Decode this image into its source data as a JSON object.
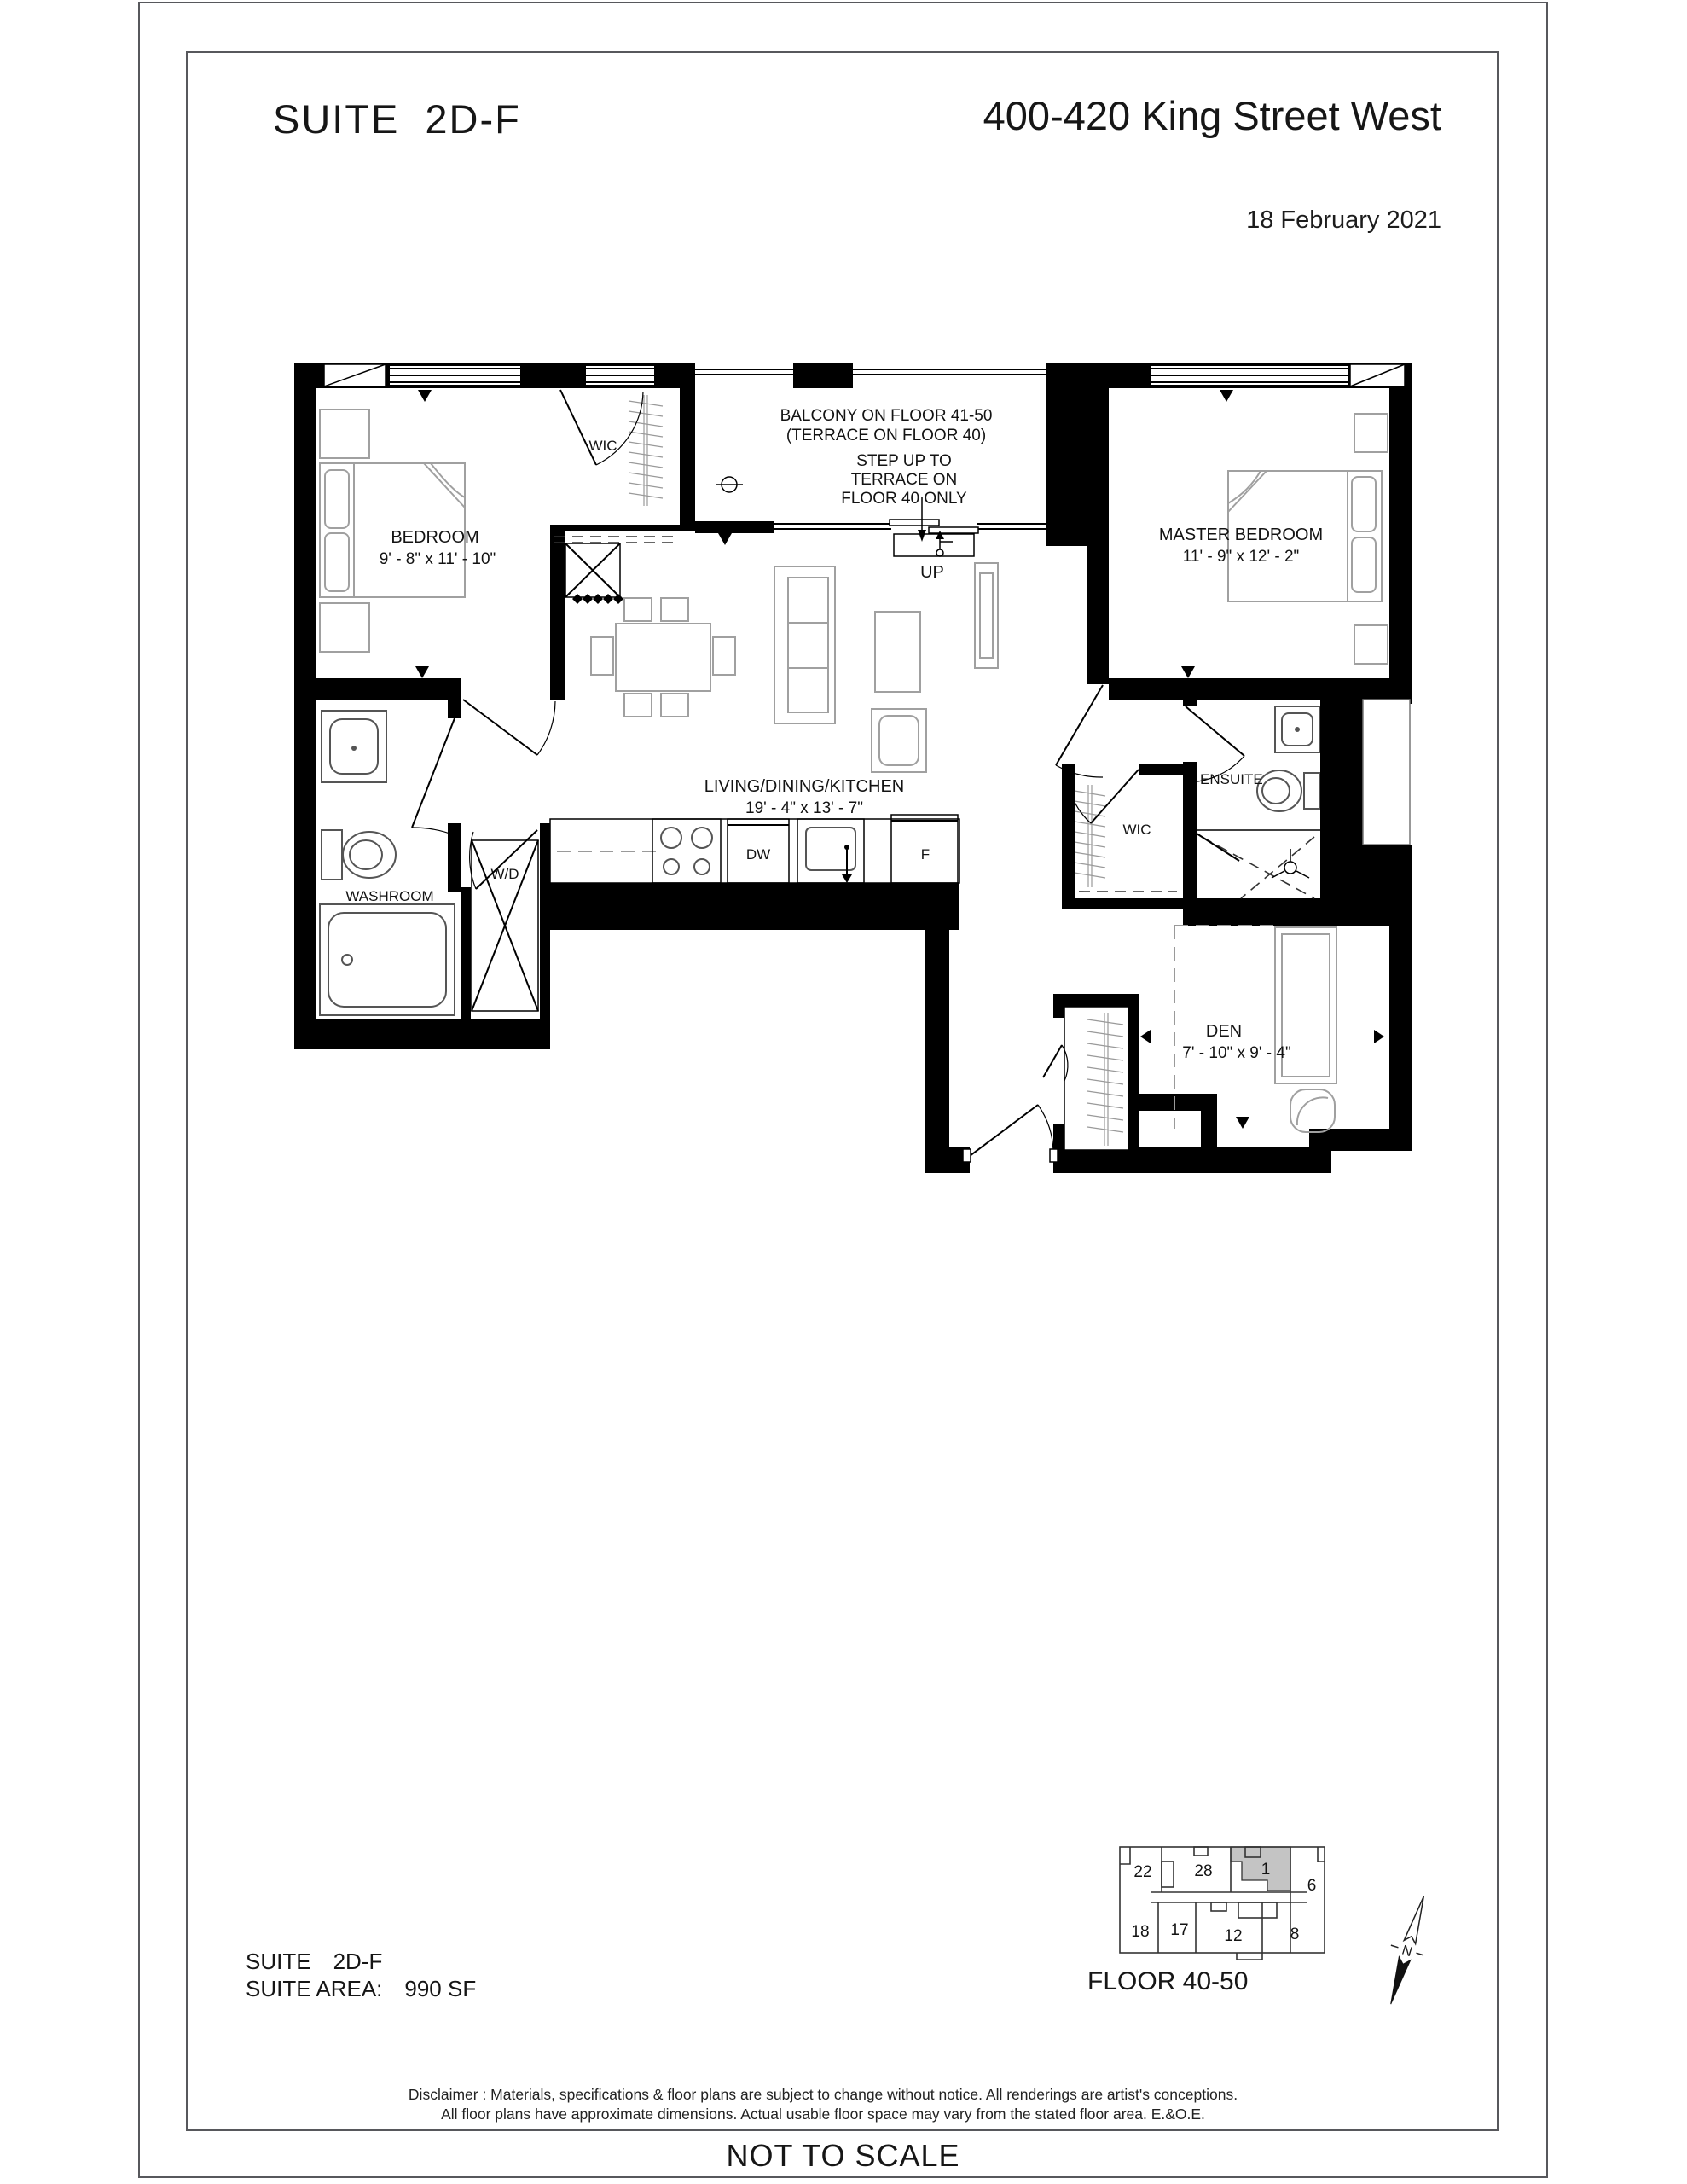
{
  "header": {
    "title_label": "SUITE",
    "title_value": "2D-F",
    "address": "400-420 King Street West",
    "date": "18 February 2021"
  },
  "rooms": {
    "bedroom": {
      "label": "BEDROOM",
      "dims": "9' - 8\" x 11' - 10\""
    },
    "master": {
      "label": "MASTER BEDROOM",
      "dims": "11' - 9\" x 12' - 2\""
    },
    "living": {
      "label": "LIVING/DINING/KITCHEN",
      "dims": "19' - 4\" x 13' - 7\""
    },
    "den": {
      "label": "DEN",
      "dims": "7' - 10\" x 9' - 4\""
    },
    "washroom": {
      "label": "WASHROOM"
    },
    "ensuite": {
      "label": "ENSUITE"
    },
    "wic_bedroom": {
      "label": "WIC"
    },
    "wic_master": {
      "label": "WIC"
    }
  },
  "fixtures": {
    "washer_dryer": "W/D",
    "dishwasher": "DW",
    "fridge": "F"
  },
  "balcony": {
    "line1": "BALCONY ON FLOOR 41-50",
    "line2": "(TERRACE ON FLOOR 40)",
    "step1": "STEP UP TO",
    "step2": "TERRACE ON",
    "step3": "FLOOR 40 ONLY",
    "up": "UP"
  },
  "suite_info": {
    "suite_label": "SUITE",
    "suite_value": "2D-F",
    "area_label": "SUITE AREA:",
    "area_value": "990 SF"
  },
  "key_plan": {
    "floor_label": "FLOOR 40-50",
    "north": "N",
    "highlighted_unit": "1",
    "units": [
      "22",
      "28",
      "1",
      "6",
      "18",
      "17",
      "12",
      "8"
    ]
  },
  "disclaimer": {
    "line1": "Disclaimer : Materials, specifications & floor plans are subject to change without notice. All renderings are artist's conceptions.",
    "line2": "All floor plans have approximate dimensions. Actual usable floor space may vary from the stated floor area. E.&O.E."
  },
  "footer": {
    "scale_note": "NOT TO SCALE"
  },
  "colors": {
    "wall": "#000000",
    "furniture_line": "#a0a0a0",
    "fixture_line": "#555555",
    "unit_highlight": "#c4c4c4",
    "frame_border": "#57585c"
  }
}
